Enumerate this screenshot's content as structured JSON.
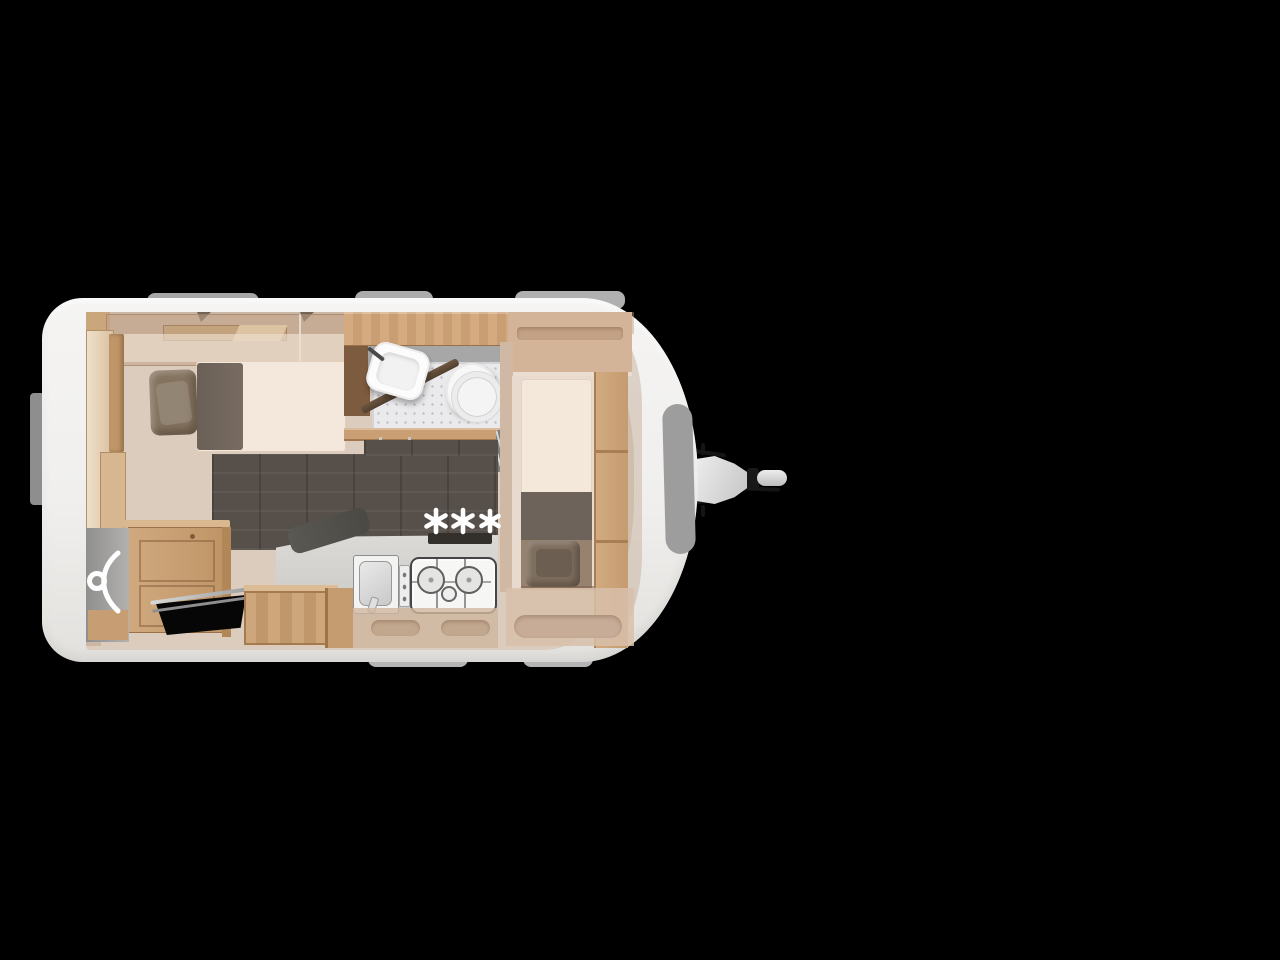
{
  "annotation": {
    "stars": "***",
    "color": "#ffffff"
  },
  "palette": {
    "background": "#000000",
    "caravan_body": "#f2f1ef",
    "roof_rail_gray": "#ababab",
    "interior_floor_beige": "#dbccbe",
    "dark_wood_floor": "#57504a",
    "cabinet_wood": "#c9a077",
    "dark_wood_wall": "#7d5b3f",
    "wall_tint": "#c3a183",
    "mattress_cream": "#f4e8dc",
    "pillow_brown": "#84735f",
    "blanket_dark": "#6f645a",
    "kitchen_counter": "#d6d5d2",
    "shower_tray": "#eaeaec",
    "sanitary_white": "#f7f7f7",
    "front_window_gray": "#9d9d9d",
    "hitch_metal": "#d2d2d2",
    "annotation_white": "#ffffff"
  },
  "icons": [
    {
      "name": "clothes-hanger-icon",
      "glyph": "hanger"
    },
    {
      "name": "three-stars-annotation",
      "glyph": "***"
    }
  ]
}
